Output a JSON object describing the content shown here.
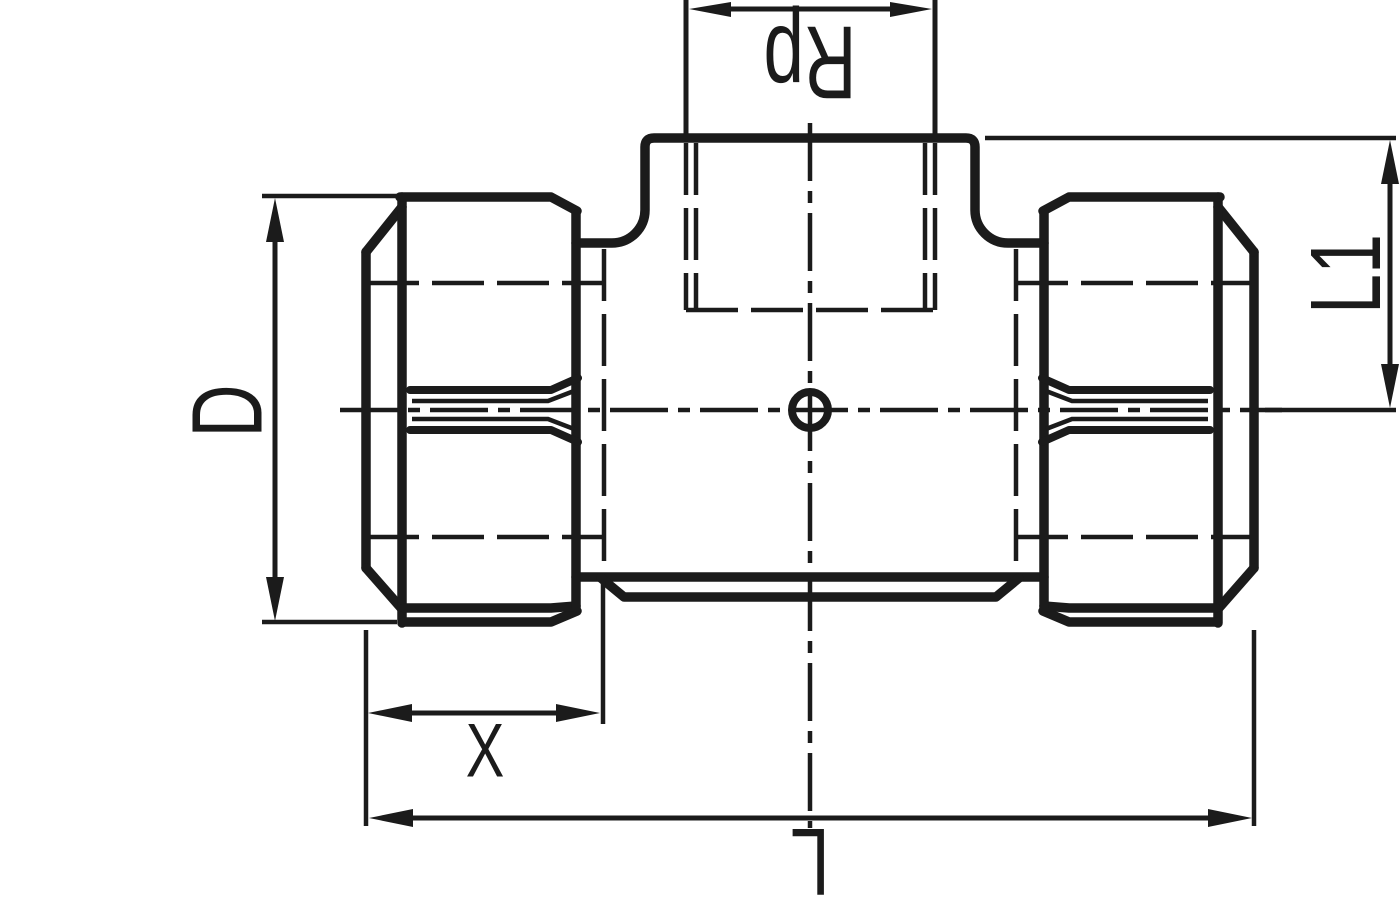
{
  "drawing": {
    "background_color": "#ffffff",
    "line_color": "#1b1b1b",
    "type_note": "technical dimension drawing of a compression tee fitting with female threaded branch",
    "labels": {
      "branch_thread": "Rp",
      "outer_diameter": "D",
      "nut_length": "X",
      "overall_length": "L",
      "branch_height": "L1"
    }
  }
}
